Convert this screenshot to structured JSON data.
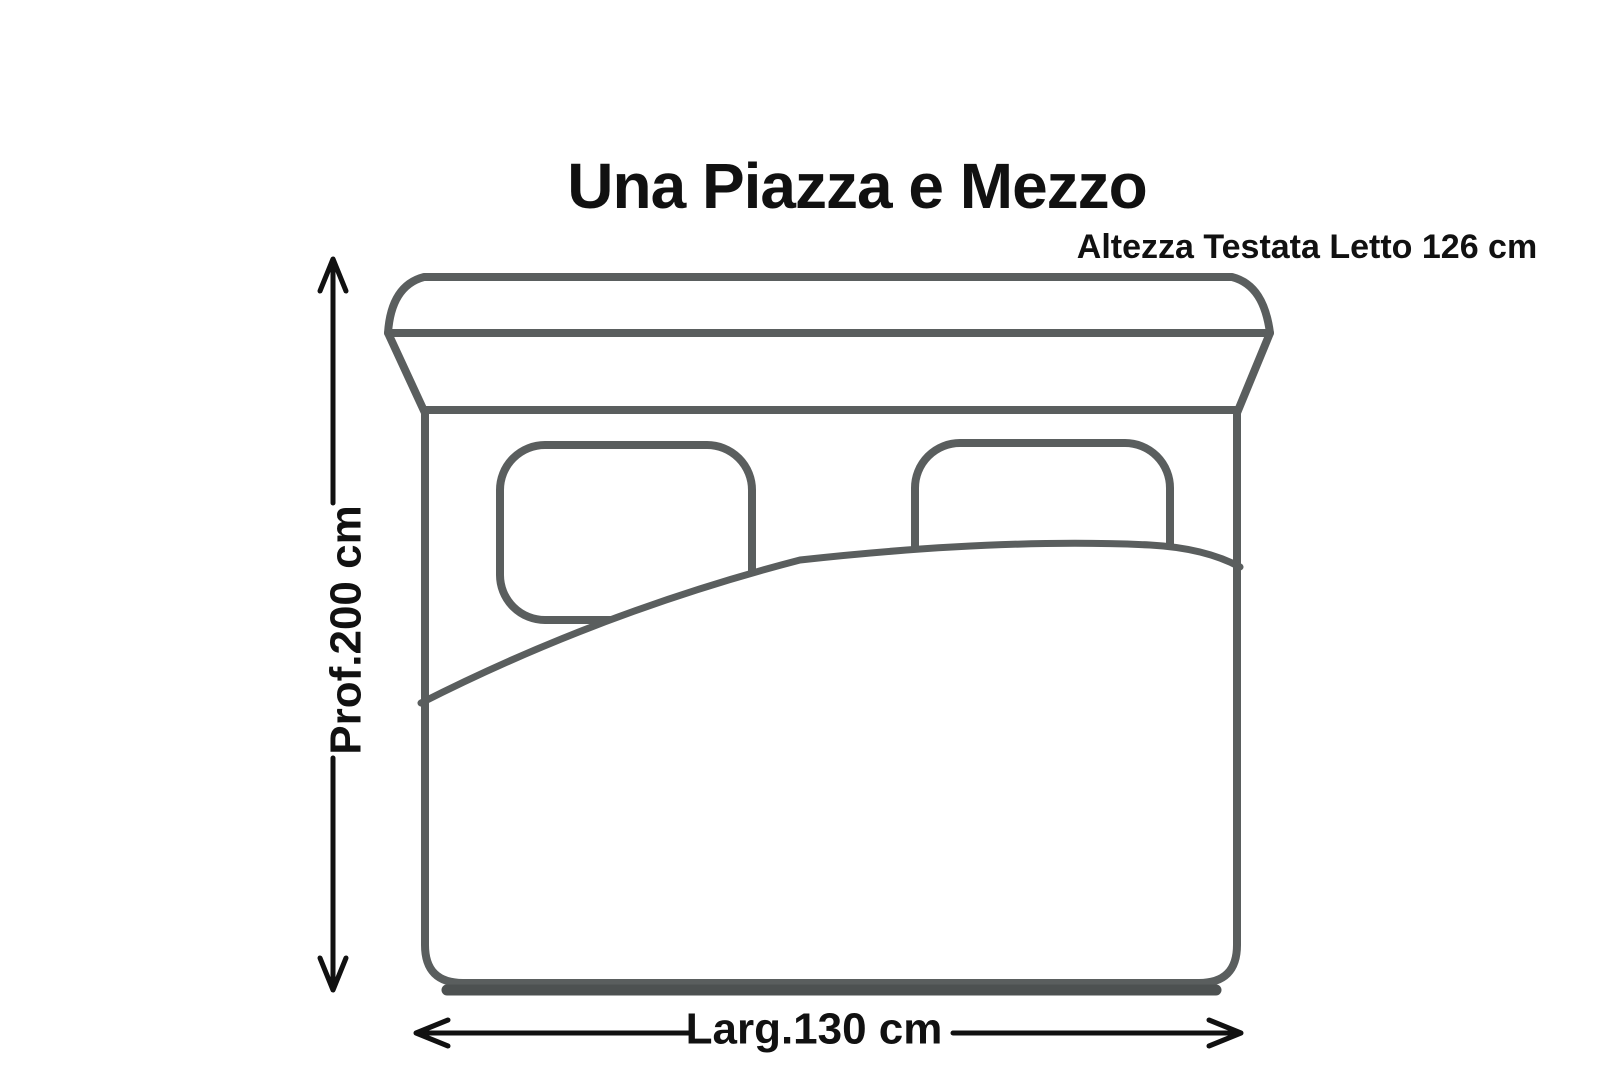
{
  "page": {
    "title": "Una Piazza e Mezzo"
  },
  "annotations": {
    "headboard_height": "Altezza Testata Letto 126 cm",
    "depth": "Prof.200 cm",
    "width": "Larg.130 cm"
  },
  "colors": {
    "background": "#ffffff",
    "bed_outline": "#5a5e5e",
    "bed_shadow": "#4d5151",
    "dimension": "#111111"
  }
}
